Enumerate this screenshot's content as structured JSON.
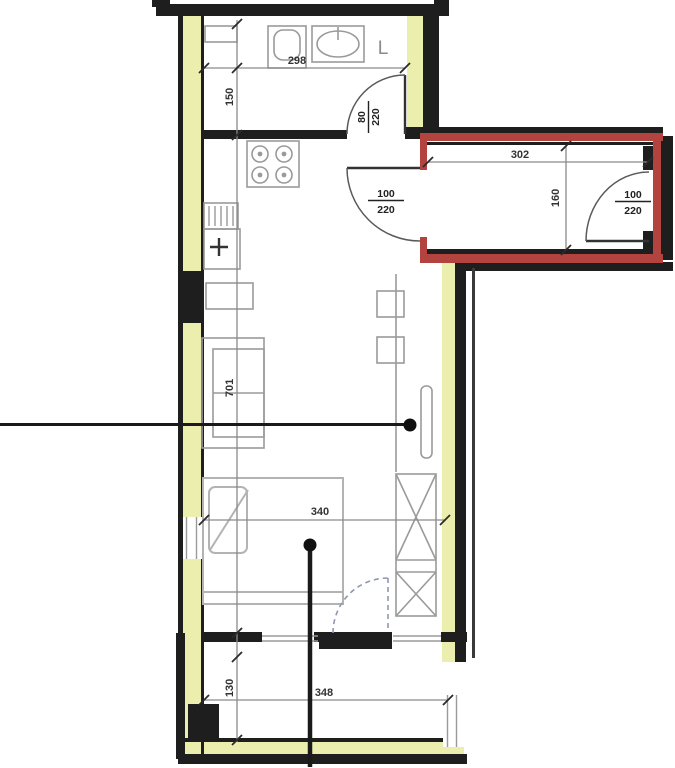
{
  "plan": {
    "labels": {
      "bath_width": "298",
      "bath_depth": "150",
      "bath_door_num": "80",
      "bath_door_den": "220",
      "hall_width": "302",
      "hall_depth": "160",
      "hall_door_num": "100",
      "hall_door_den": "220",
      "entry_door_num": "100",
      "entry_door_den": "220",
      "room_length": "701",
      "bedroom_width": "340",
      "balcony_width": "348",
      "balcony_depth": "130",
      "fixture_letter": "L"
    },
    "colors": {
      "wall": "#1e1e1e",
      "insulation": "#eceeae",
      "highlight_red": "#b2433f",
      "dim_line": "#8a8a8a",
      "furniture": "#9a9a9a",
      "dashed_door": "#8e99ad"
    }
  }
}
